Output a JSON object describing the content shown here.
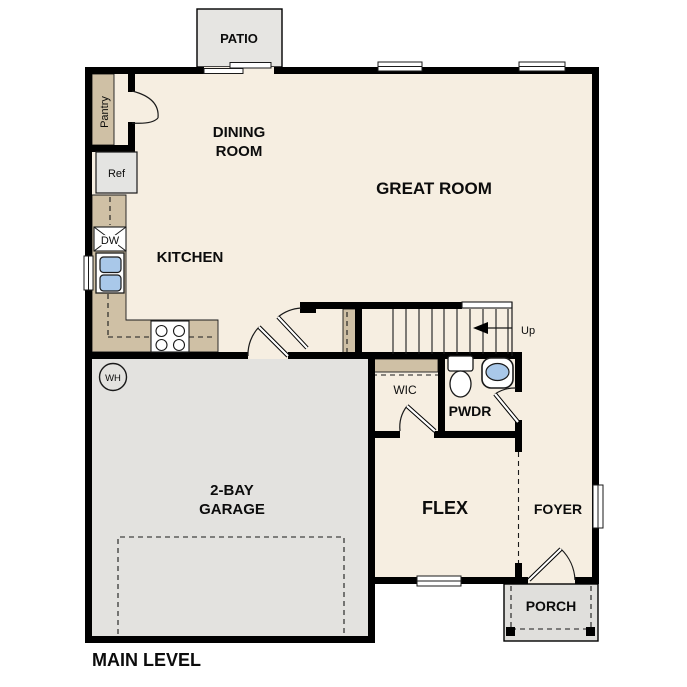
{
  "title": "MAIN LEVEL",
  "rooms": {
    "patio": "PATIO",
    "dining_line1": "DINING",
    "dining_line2": "ROOM",
    "great_room": "GREAT ROOM",
    "kitchen": "KITCHEN",
    "pantry": "Pantry",
    "garage_line1": "2-BAY",
    "garage_line2": "GARAGE",
    "wic": "WIC",
    "pwdr": "PWDR",
    "flex": "FLEX",
    "foyer": "FOYER",
    "porch": "PORCH"
  },
  "labels": {
    "ref": "Ref",
    "dishwasher": "DW",
    "water_heater": "WH",
    "stairs_up": "Up"
  },
  "colors": {
    "paper": "#ffffff",
    "floor": "#f6eee1",
    "casework": "#cfc0a5",
    "garage-floor": "#e3e2df",
    "patio-floor": "#e6e5e2",
    "porch-floor": "#e0dfdc",
    "wall": "#000000",
    "line": "#1a1a1a",
    "fixture-blue": "#a9c8e9"
  }
}
